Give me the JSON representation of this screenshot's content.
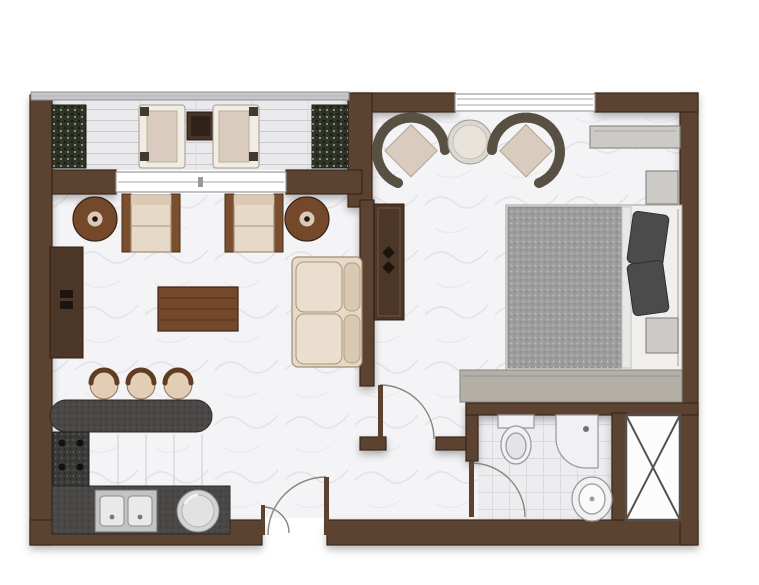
{
  "canvas": {
    "width": 759,
    "height": 585,
    "background": "#ffffff"
  },
  "colors": {
    "wall": "#5c4230",
    "railing": "#c7c7cb",
    "floor_marble": "#f4f4f6",
    "balcony_plank": "#eaeaed",
    "bath_tile": "#ededf0",
    "wood": "#74482a",
    "wood_dark": "#4c3628",
    "counter": "#4a4846",
    "steel": "#c3c3c3",
    "fabric": "#e7d9c7",
    "cushion": "#d9cbbd",
    "wicker": "#6a6254",
    "plant": "#2e3227",
    "blanket": "#9d9d9d",
    "pillow": "#4b4b4b",
    "bed_frame": "#f0efed",
    "gray_item": "#cccac6",
    "dresser": "#b4b0a8",
    "fixture": "#f1f1f3",
    "fixture_line": "#9b9ba1",
    "shaft_line": "#57504a",
    "door_arc": "#8b847b"
  },
  "legend": {
    "rooms": [
      "balcony",
      "living-room",
      "kitchen",
      "hallway",
      "bedroom",
      "bathroom",
      "service-shaft"
    ],
    "balcony_items": [
      "planter",
      "lounge-chair",
      "lounge-chair",
      "balcony-table",
      "glass-railing",
      "sliding-door"
    ],
    "living_items": [
      "side-table",
      "armchair",
      "armchair",
      "side-table",
      "tv-console",
      "coffee-table",
      "sofa"
    ],
    "kitchen_items": [
      "bar-stool",
      "bar-stool",
      "bar-stool",
      "bar-counter",
      "stove",
      "double-sink",
      "washer"
    ],
    "bedroom_items": [
      "wicker-chair",
      "round-table",
      "wicker-chair",
      "wall-shelf",
      "nightstand",
      "bed",
      "pillow",
      "pillow",
      "nightstand",
      "wardrobe",
      "dresser",
      "window"
    ],
    "bathroom_items": [
      "toilet",
      "sink",
      "shower-basin"
    ],
    "doors": [
      "entrance-door",
      "bedroom-door",
      "bathroom-door"
    ]
  }
}
